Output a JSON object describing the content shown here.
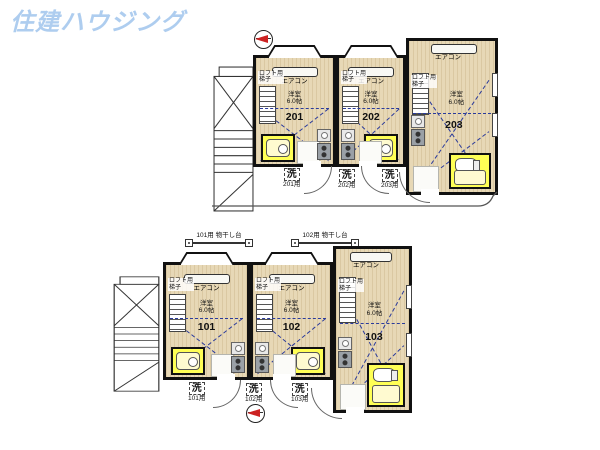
{
  "logo": "住建ハウジング",
  "labels": {
    "aircon": "エアコン",
    "loft_ladder_line1": "ロフト用",
    "loft_ladder_line2": "梯子",
    "room_type": "洋室",
    "room_size": "6.0帖",
    "wash": "洗"
  },
  "floors": {
    "second": {
      "units": [
        {
          "number": "201",
          "wash_for": "201用"
        },
        {
          "number": "202",
          "wash_for": "202用"
        },
        {
          "number": "203",
          "wash_for": "203用"
        }
      ]
    },
    "first": {
      "units": [
        {
          "number": "101",
          "wash_for": "101用"
        },
        {
          "number": "102",
          "wash_for": "102用"
        },
        {
          "number": "103",
          "wash_for": "103用"
        }
      ],
      "drying_racks": [
        "101用 物干し台",
        "102用 物干し台"
      ]
    }
  },
  "colors": {
    "logo_blue": "#aecdef",
    "floor_beige": "#e7d8b6",
    "bath_yellow": "#ffff55",
    "loft_line_blue": "#2b3b9b",
    "compass_red": "#cc2222",
    "wall_black": "#111111"
  }
}
